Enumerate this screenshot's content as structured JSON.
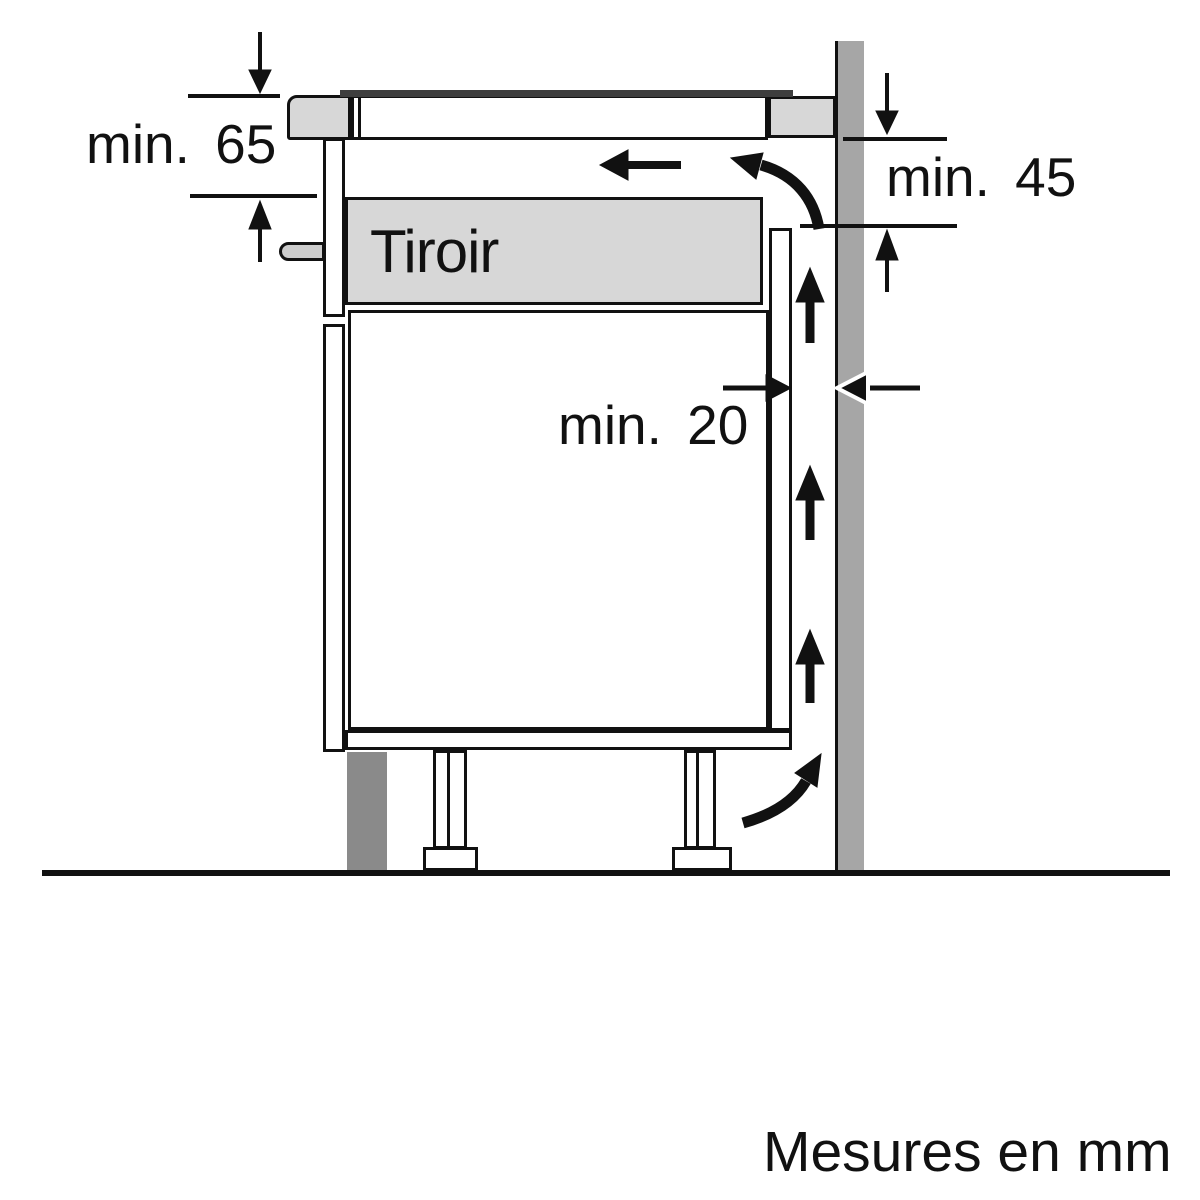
{
  "diagram": {
    "title": "Hob installation side-view clearance diagram",
    "drawer_label": "Tiroir",
    "unit_note": "Mesures en mm",
    "dimensions": [
      {
        "id": "clearance-below-worktop",
        "label": "min. 65"
      },
      {
        "id": "clearance-wall-vent-height",
        "label": "min. 45"
      },
      {
        "id": "gap-panel-to-wall",
        "label": "min. 20"
      }
    ],
    "icons": [
      "dimension-arrow-down",
      "dimension-arrow-up",
      "airflow-left-arrow",
      "airflow-curved-top-arrow",
      "airflow-up-arrow",
      "airflow-curved-bottom-arrow",
      "gap-arrow-right",
      "gap-arrow-left"
    ],
    "colors": {
      "ink": "#111111",
      "surface_gray": "#d7d7d7",
      "wall_gray": "#a6a6a6",
      "plinth_gray": "#8a8a8a",
      "glass_dark": "#3e3e3e",
      "handle_gray": "#cccccc",
      "background": "#ffffff"
    }
  }
}
